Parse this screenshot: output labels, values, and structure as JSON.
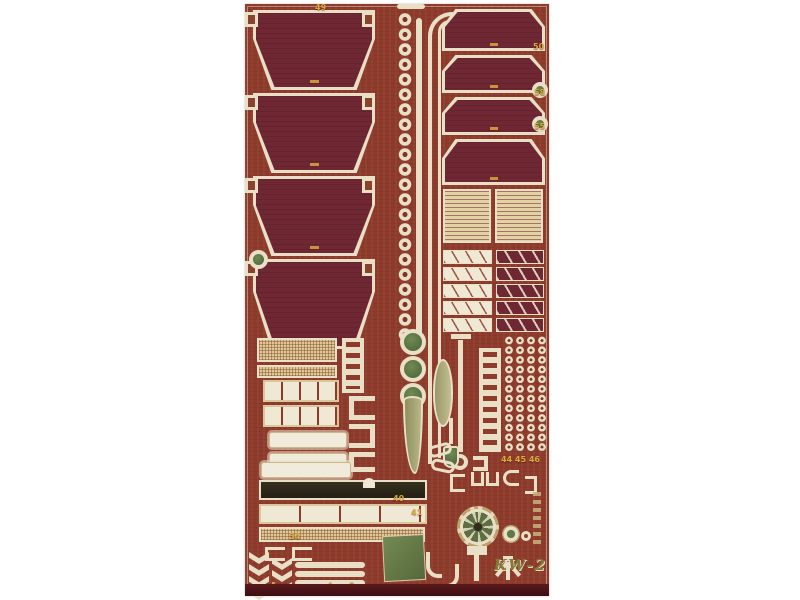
{
  "photo": {
    "etched_label": "KW-2",
    "part_number_markers": [
      {
        "x": 70,
        "y": -1,
        "label": "49"
      },
      {
        "x": 288,
        "y": 38,
        "label": "50"
      },
      {
        "x": 289,
        "y": 84,
        "label": "58"
      },
      {
        "x": 289,
        "y": 118,
        "label": "55"
      },
      {
        "x": 148,
        "y": 490,
        "label": "40"
      },
      {
        "x": 166,
        "y": 504,
        "label": "41"
      },
      {
        "x": 256,
        "y": 451,
        "label": "44 45 46"
      },
      {
        "x": 44,
        "y": 528,
        "label": "54"
      },
      {
        "x": 26,
        "y": 577,
        "label": "1"
      },
      {
        "x": 82,
        "y": 577,
        "label": "4"
      },
      {
        "x": 104,
        "y": 577,
        "label": "9"
      }
    ],
    "colors": {
      "background": "#ffffff",
      "fret_base": "#8e3b2c",
      "panel_fill": "#6e2733",
      "etched_metal": "#e9dfc6",
      "brass_mesh": "#ddc795",
      "hole_green": "#5f7a45",
      "marker_yellow": "#d8ab3c",
      "bottom_edge": "#4a1016",
      "label_olive": "#7f7c35"
    }
  }
}
